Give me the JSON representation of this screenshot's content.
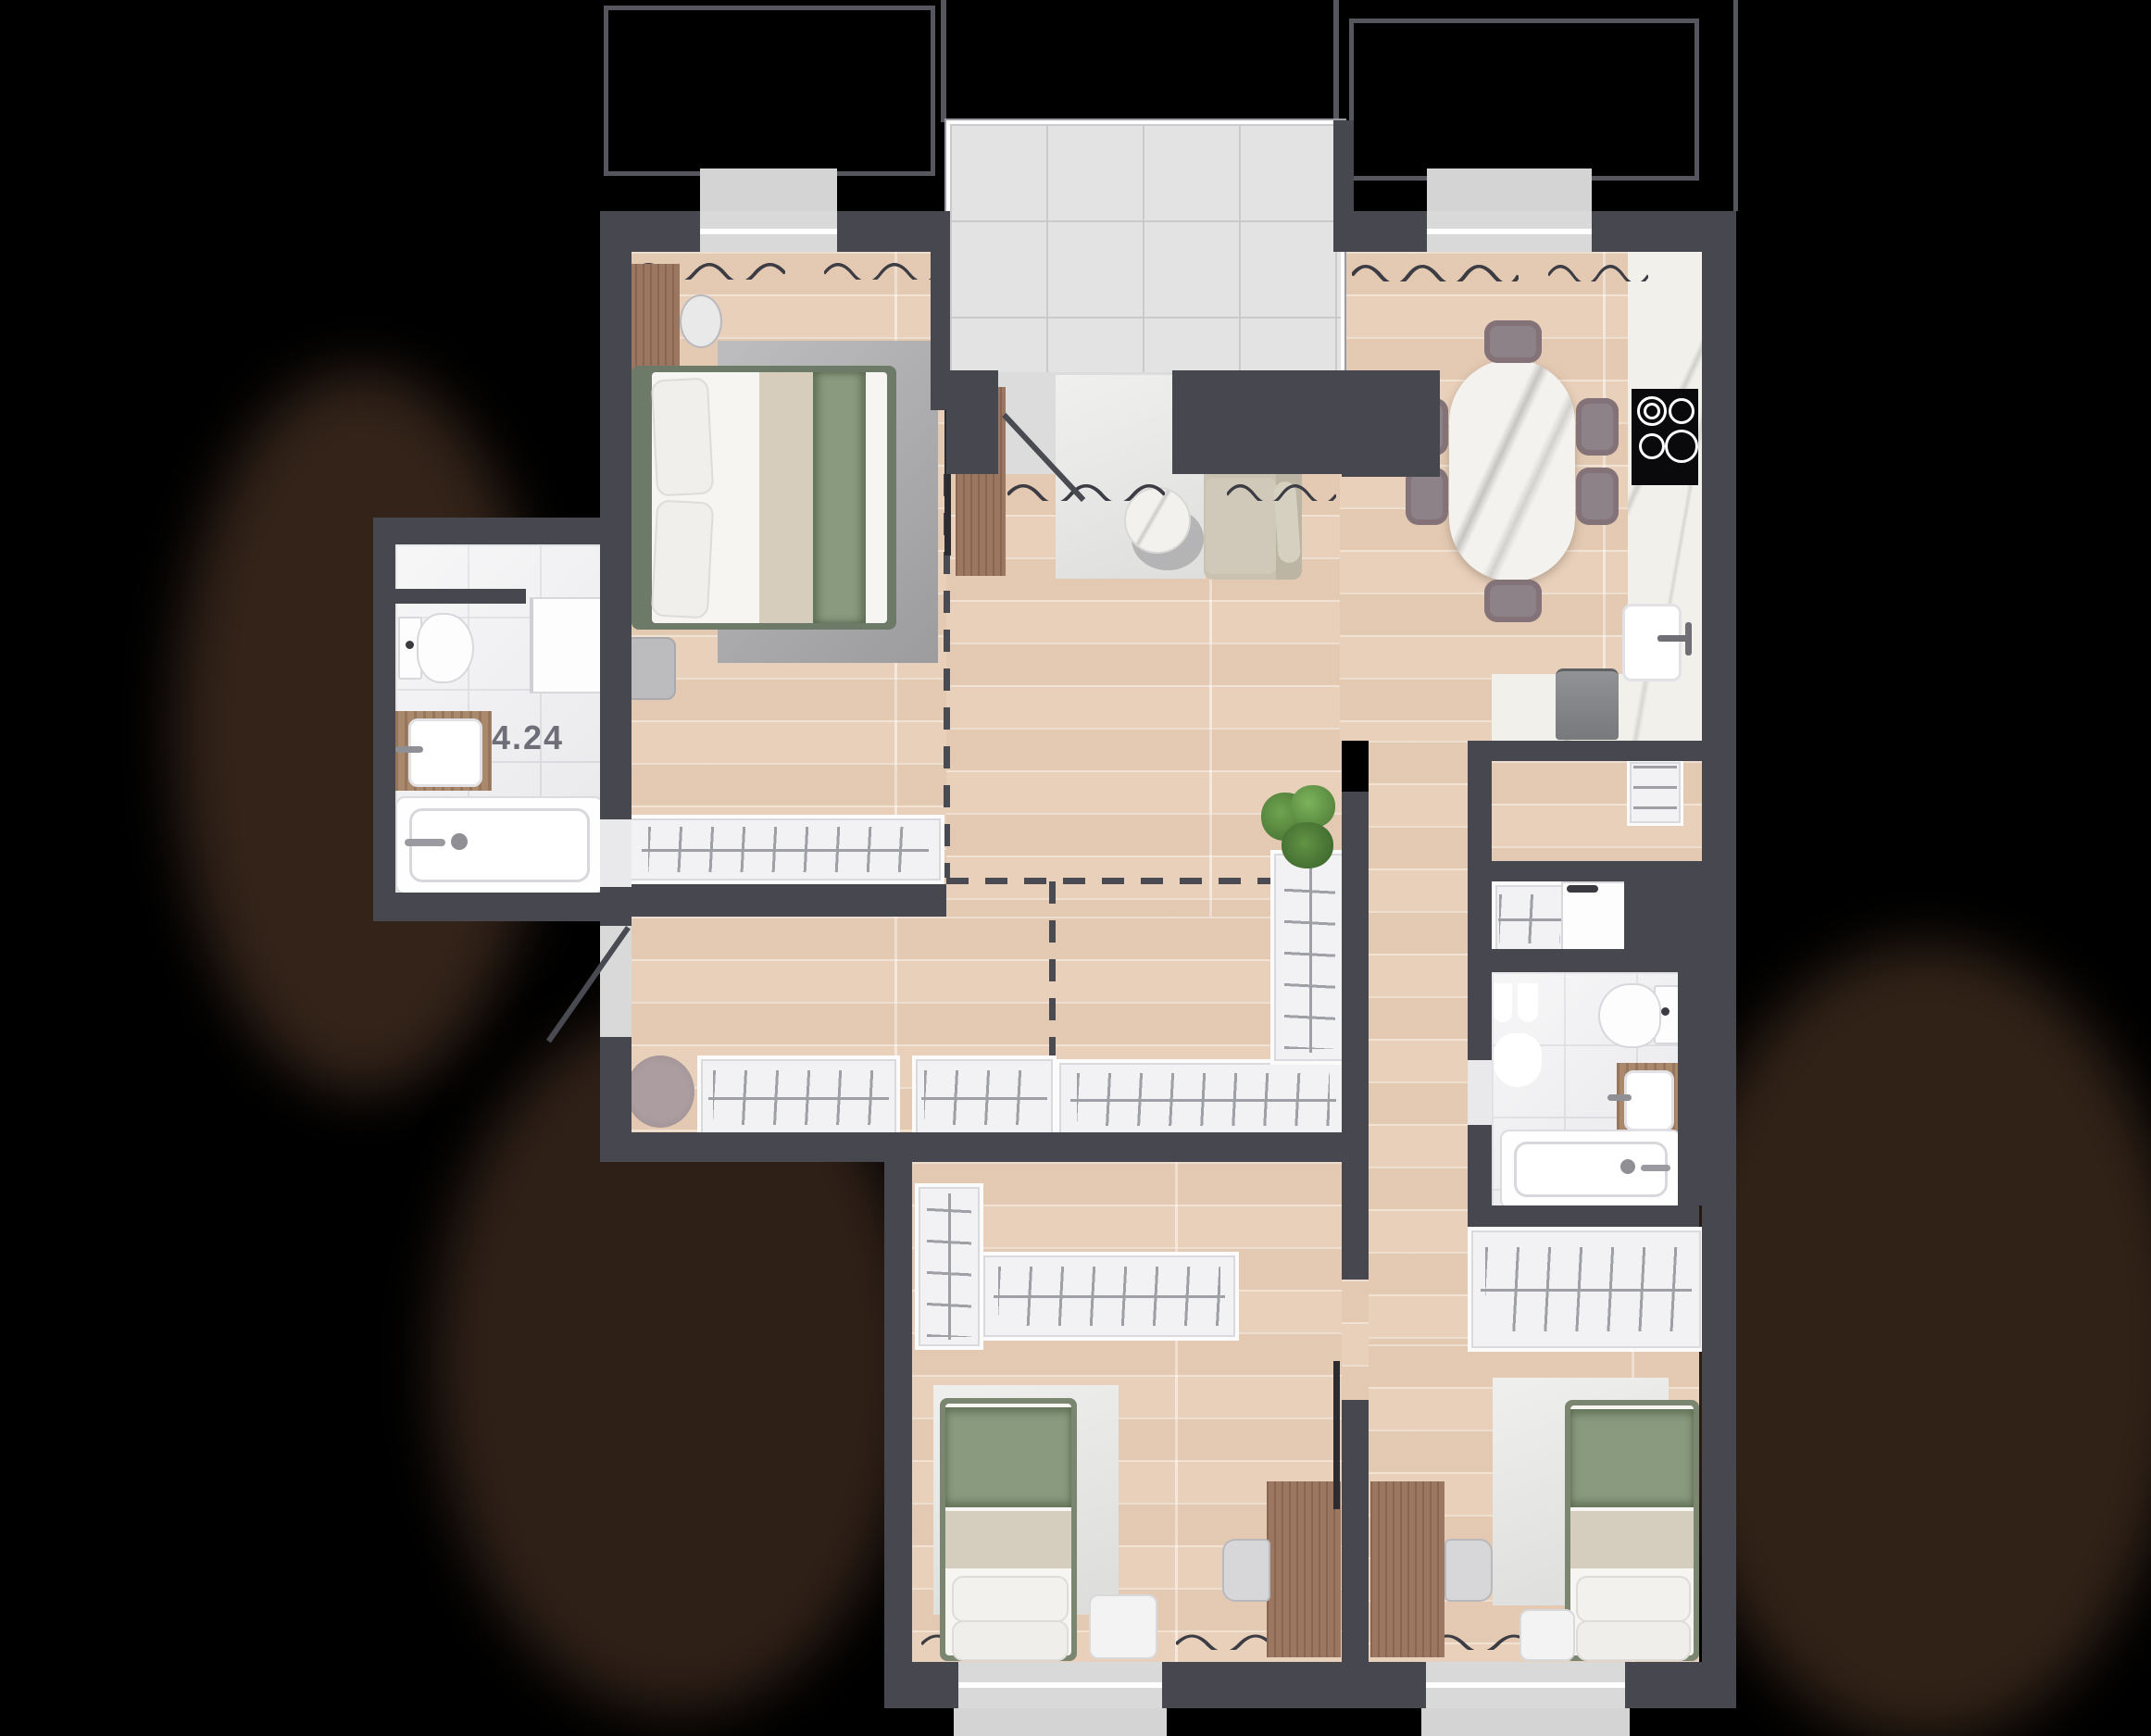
{
  "floor_plan": {
    "bathroom_area_label": "4.24",
    "colors": {
      "background": "#000000",
      "wall": "#47474f",
      "wood_floor": "#e9d0ba",
      "bathroom_tile": "#ededef",
      "balcony_tile": "#e3e3e4",
      "counter_marble": "#f1f0ea",
      "accent_green": "#8a9a7e",
      "rug_grey": "#b4b4b6",
      "outline_grey": "#56565e"
    },
    "icons": [
      "double-bed-icon",
      "single-bed-icon",
      "sofa-icon",
      "coffee-table-icon",
      "dining-table-icon",
      "dining-chair-icon",
      "desk-icon",
      "desk-chair-icon",
      "wardrobe-icon",
      "toilet-icon",
      "bathtub-icon",
      "sink-icon",
      "washing-machine-icon",
      "fridge-icon",
      "cooktop-icon",
      "kitchen-sink-icon",
      "plant-icon",
      "rug-icon",
      "tv-icon",
      "radiator-icon",
      "door-swing-icon",
      "window-icon",
      "balcony-icon"
    ],
    "rooms": [
      {
        "name": "master-bedroom",
        "furniture": [
          "double-bed",
          "desk",
          "chair",
          "rug",
          "tv-console",
          "wardrobe"
        ]
      },
      {
        "name": "living-room",
        "furniture": [
          "sofa",
          "rug",
          "coffee-table"
        ]
      },
      {
        "name": "kitchen-dining",
        "furniture": [
          "dining-table",
          "6-chairs",
          "counter",
          "cooktop",
          "sink",
          "fridge"
        ]
      },
      {
        "name": "bathroom-1",
        "furniture": [
          "toilet",
          "sink",
          "bathtub",
          "cabinet"
        ],
        "area_label": "4.24"
      },
      {
        "name": "hallway",
        "furniture": [
          "wardrobes",
          "entry-door",
          "plant",
          "rug"
        ]
      },
      {
        "name": "bathroom-2",
        "furniture": [
          "toilet",
          "sink",
          "bathtub",
          "towel-rail"
        ]
      },
      {
        "name": "utility-closet",
        "furniture": [
          "wardrobe",
          "washing-machine"
        ]
      },
      {
        "name": "bedroom-2",
        "furniture": [
          "single-bed",
          "rug",
          "desk",
          "chair",
          "wardrobes",
          "nightstand",
          "tv"
        ]
      },
      {
        "name": "bedroom-3",
        "furniture": [
          "single-bed",
          "rug",
          "desk",
          "chair",
          "wardrobe",
          "nightstand"
        ]
      }
    ]
  }
}
